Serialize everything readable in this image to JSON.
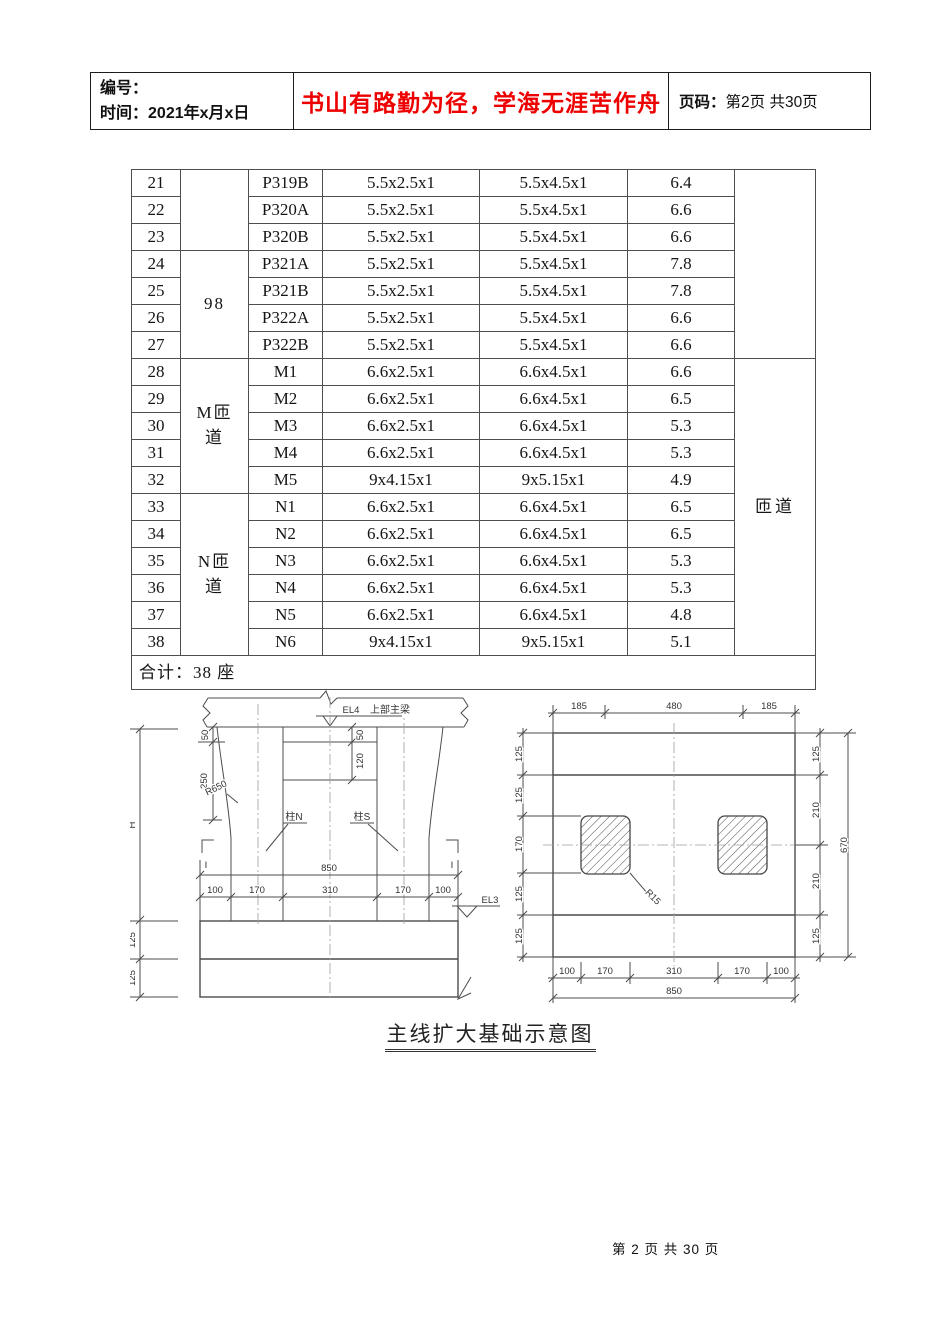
{
  "colors": {
    "motto_red": "#ee0000"
  },
  "header": {
    "number_label": "编号：",
    "time_label": "时间：",
    "time_value": "2021年x月x日",
    "motto": "书山有路勤为径，学海无涯苦作舟",
    "page_label": "页码：",
    "page_value": "第2页 共30页"
  },
  "table": {
    "groups": {
      "g1": "",
      "g2": "98",
      "g3": "M匝道",
      "g4": "N匝道"
    },
    "sides": {
      "s1": "",
      "s2": "匝道"
    },
    "rows": [
      {
        "no": "21",
        "pier": "P319B",
        "d1": "5.5x2.5x1",
        "d2": "5.5x4.5x1",
        "v": "6.4"
      },
      {
        "no": "22",
        "pier": "P320A",
        "d1": "5.5x2.5x1",
        "d2": "5.5x4.5x1",
        "v": "6.6"
      },
      {
        "no": "23",
        "pier": "P320B",
        "d1": "5.5x2.5x1",
        "d2": "5.5x4.5x1",
        "v": "6.6"
      },
      {
        "no": "24",
        "pier": "P321A",
        "d1": "5.5x2.5x1",
        "d2": "5.5x4.5x1",
        "v": "7.8"
      },
      {
        "no": "25",
        "pier": "P321B",
        "d1": "5.5x2.5x1",
        "d2": "5.5x4.5x1",
        "v": "7.8"
      },
      {
        "no": "26",
        "pier": "P322A",
        "d1": "5.5x2.5x1",
        "d2": "5.5x4.5x1",
        "v": "6.6"
      },
      {
        "no": "27",
        "pier": "P322B",
        "d1": "5.5x2.5x1",
        "d2": "5.5x4.5x1",
        "v": "6.6"
      },
      {
        "no": "28",
        "pier": "M1",
        "d1": "6.6x2.5x1",
        "d2": "6.6x4.5x1",
        "v": "6.6"
      },
      {
        "no": "29",
        "pier": "M2",
        "d1": "6.6x2.5x1",
        "d2": "6.6x4.5x1",
        "v": "6.5"
      },
      {
        "no": "30",
        "pier": "M3",
        "d1": "6.6x2.5x1",
        "d2": "6.6x4.5x1",
        "v": "5.3"
      },
      {
        "no": "31",
        "pier": "M4",
        "d1": "6.6x2.5x1",
        "d2": "6.6x4.5x1",
        "v": "5.3"
      },
      {
        "no": "32",
        "pier": "M5",
        "d1": "9x4.15x1",
        "d2": "9x5.15x1",
        "v": "4.9"
      },
      {
        "no": "33",
        "pier": "N1",
        "d1": "6.6x2.5x1",
        "d2": "6.6x4.5x1",
        "v": "6.5"
      },
      {
        "no": "34",
        "pier": "N2",
        "d1": "6.6x2.5x1",
        "d2": "6.6x4.5x1",
        "v": "6.5"
      },
      {
        "no": "35",
        "pier": "N3",
        "d1": "6.6x2.5x1",
        "d2": "6.6x4.5x1",
        "v": "5.3"
      },
      {
        "no": "36",
        "pier": "N4",
        "d1": "6.6x2.5x1",
        "d2": "6.6x4.5x1",
        "v": "5.3"
      },
      {
        "no": "37",
        "pier": "N5",
        "d1": "6.6x2.5x1",
        "d2": "6.6x4.5x1",
        "v": "4.8"
      },
      {
        "no": "38",
        "pier": "N6",
        "d1": "9x4.15x1",
        "d2": "9x5.15x1",
        "v": "5.1"
      }
    ],
    "total": "合计：38 座"
  },
  "drawings": {
    "elevation": {
      "beam_level_label": "EL4",
      "beam_label": "上部主梁",
      "cap_dims": [
        "50",
        "250"
      ],
      "mid_dims": [
        "50",
        "120"
      ],
      "radius_label": "R650",
      "height_label": "H",
      "column_labels": [
        "柱N",
        "柱S"
      ],
      "section_label": "I",
      "overall_width": "850",
      "width_chain": [
        "100",
        "170",
        "310",
        "170",
        "100"
      ],
      "ground_level_label": "EL3",
      "footing_dims": [
        "125",
        "125"
      ]
    },
    "plan": {
      "top_chain": [
        "185",
        "480",
        "185"
      ],
      "right_chain": [
        "125",
        "210",
        "210",
        "125"
      ],
      "overall_height": "670",
      "left_chain": [
        "125",
        "125",
        "170",
        "125",
        "125"
      ],
      "bottom_chain": [
        "100",
        "170",
        "310",
        "170",
        "100"
      ],
      "overall_width": "850",
      "corner_radius_label": "R15"
    }
  },
  "caption": "主线扩大基础示意图",
  "footer": "第 2 页 共 30 页"
}
